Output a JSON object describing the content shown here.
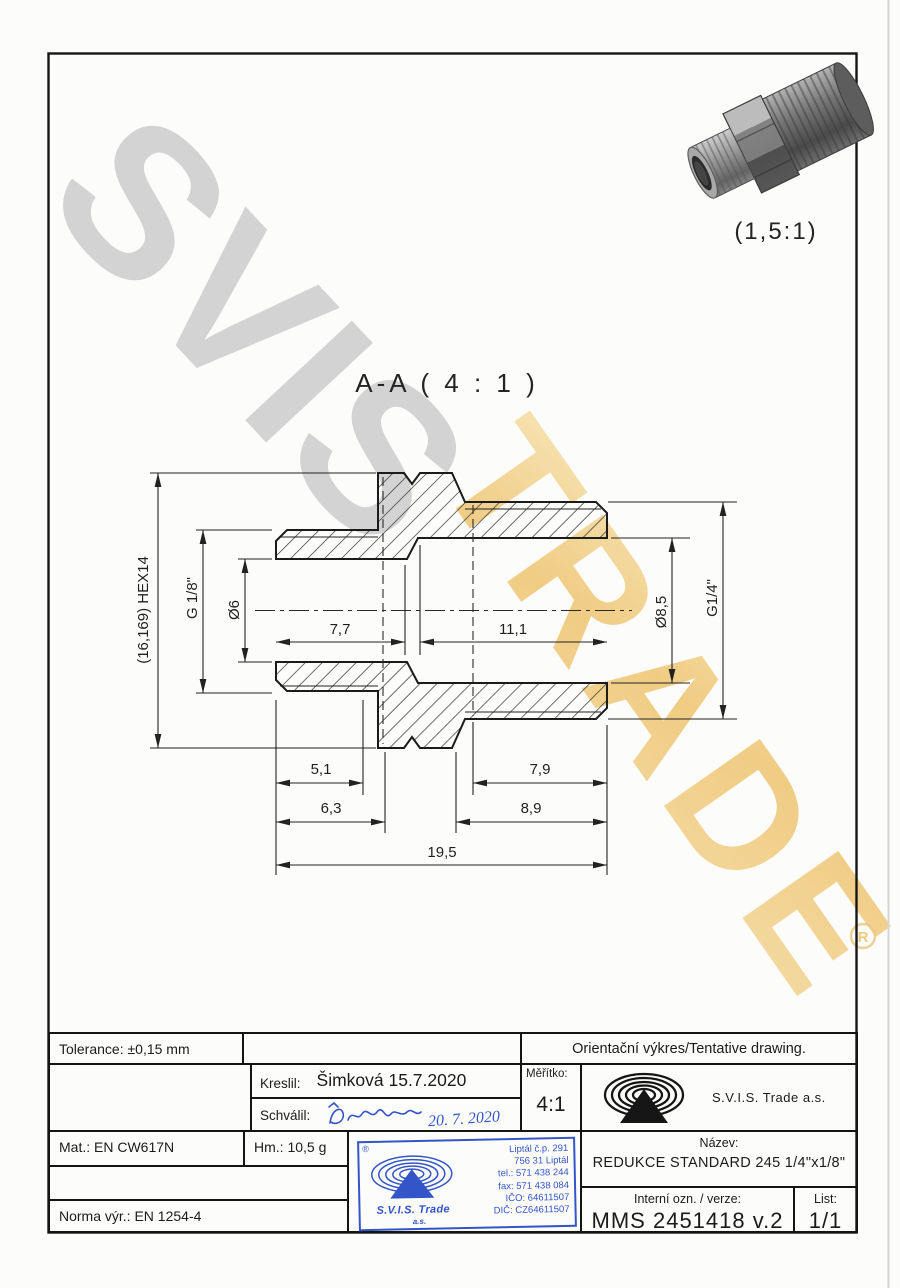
{
  "watermark": {
    "gray_text": "SVIS",
    "gold_text": "TRADE",
    "registered_mark": "®"
  },
  "pictorial_view": {
    "scale_label": "(1,5:1)"
  },
  "section_view": {
    "title": "A-A ( 4 : 1 )"
  },
  "dimensions": {
    "hex_width": "(16,169) HEX14",
    "thread_left": "G 1/8\"",
    "bore_left": "Ø6",
    "bore_right": "Ø8,5",
    "thread_right": "G1/4\"",
    "depth_left": "7,7",
    "depth_right": "11,1",
    "len_51": "5,1",
    "len_79": "7,9",
    "len_63": "6,3",
    "len_89": "8,9",
    "len_total": "19,5"
  },
  "title_block": {
    "tolerance": "Tolerance: ±0,15 mm",
    "orientacni": "Orientační výkres/Tentative drawing.",
    "kreslil_label": "Kreslil:",
    "kreslil_value": "Šimková 15.7.2020",
    "schvalil_label": "Schválil:",
    "schvalil_sig_date": "20. 7. 2020",
    "meritko_label": "Měřítko:",
    "meritko_value": "4:1",
    "company": "S.V.I.S. Trade a.s.",
    "mat": "Mat.: EN CW617N",
    "hm": "Hm.: 10,5 g",
    "norma": "Norma výr.: EN 1254-4",
    "nazev_label": "Název:",
    "nazev_value": "REDUKCE STANDARD 245 1/4\"x1/8\"",
    "interni_label": "Interní ozn. / verze:",
    "interni_value": "MMS 2451418 v.2",
    "list_label": "List:",
    "list_value": "1/1"
  },
  "stamp": {
    "reg": "®",
    "company": "S.V.I.S. Trade",
    "suffix": "a.s.",
    "lines": [
      "Liptál č.p. 291",
      "756 31 Liptál",
      "tel.: 571 438 244",
      "fax: 571 438 084",
      "IČO: 64611507",
      "DIČ: CZ64611507"
    ]
  },
  "colors": {
    "stamp-blue": "#3355c8",
    "wm-gray": "#c9c9cb",
    "wm-gold": "#eec26a",
    "line": "#1c1c1c"
  }
}
